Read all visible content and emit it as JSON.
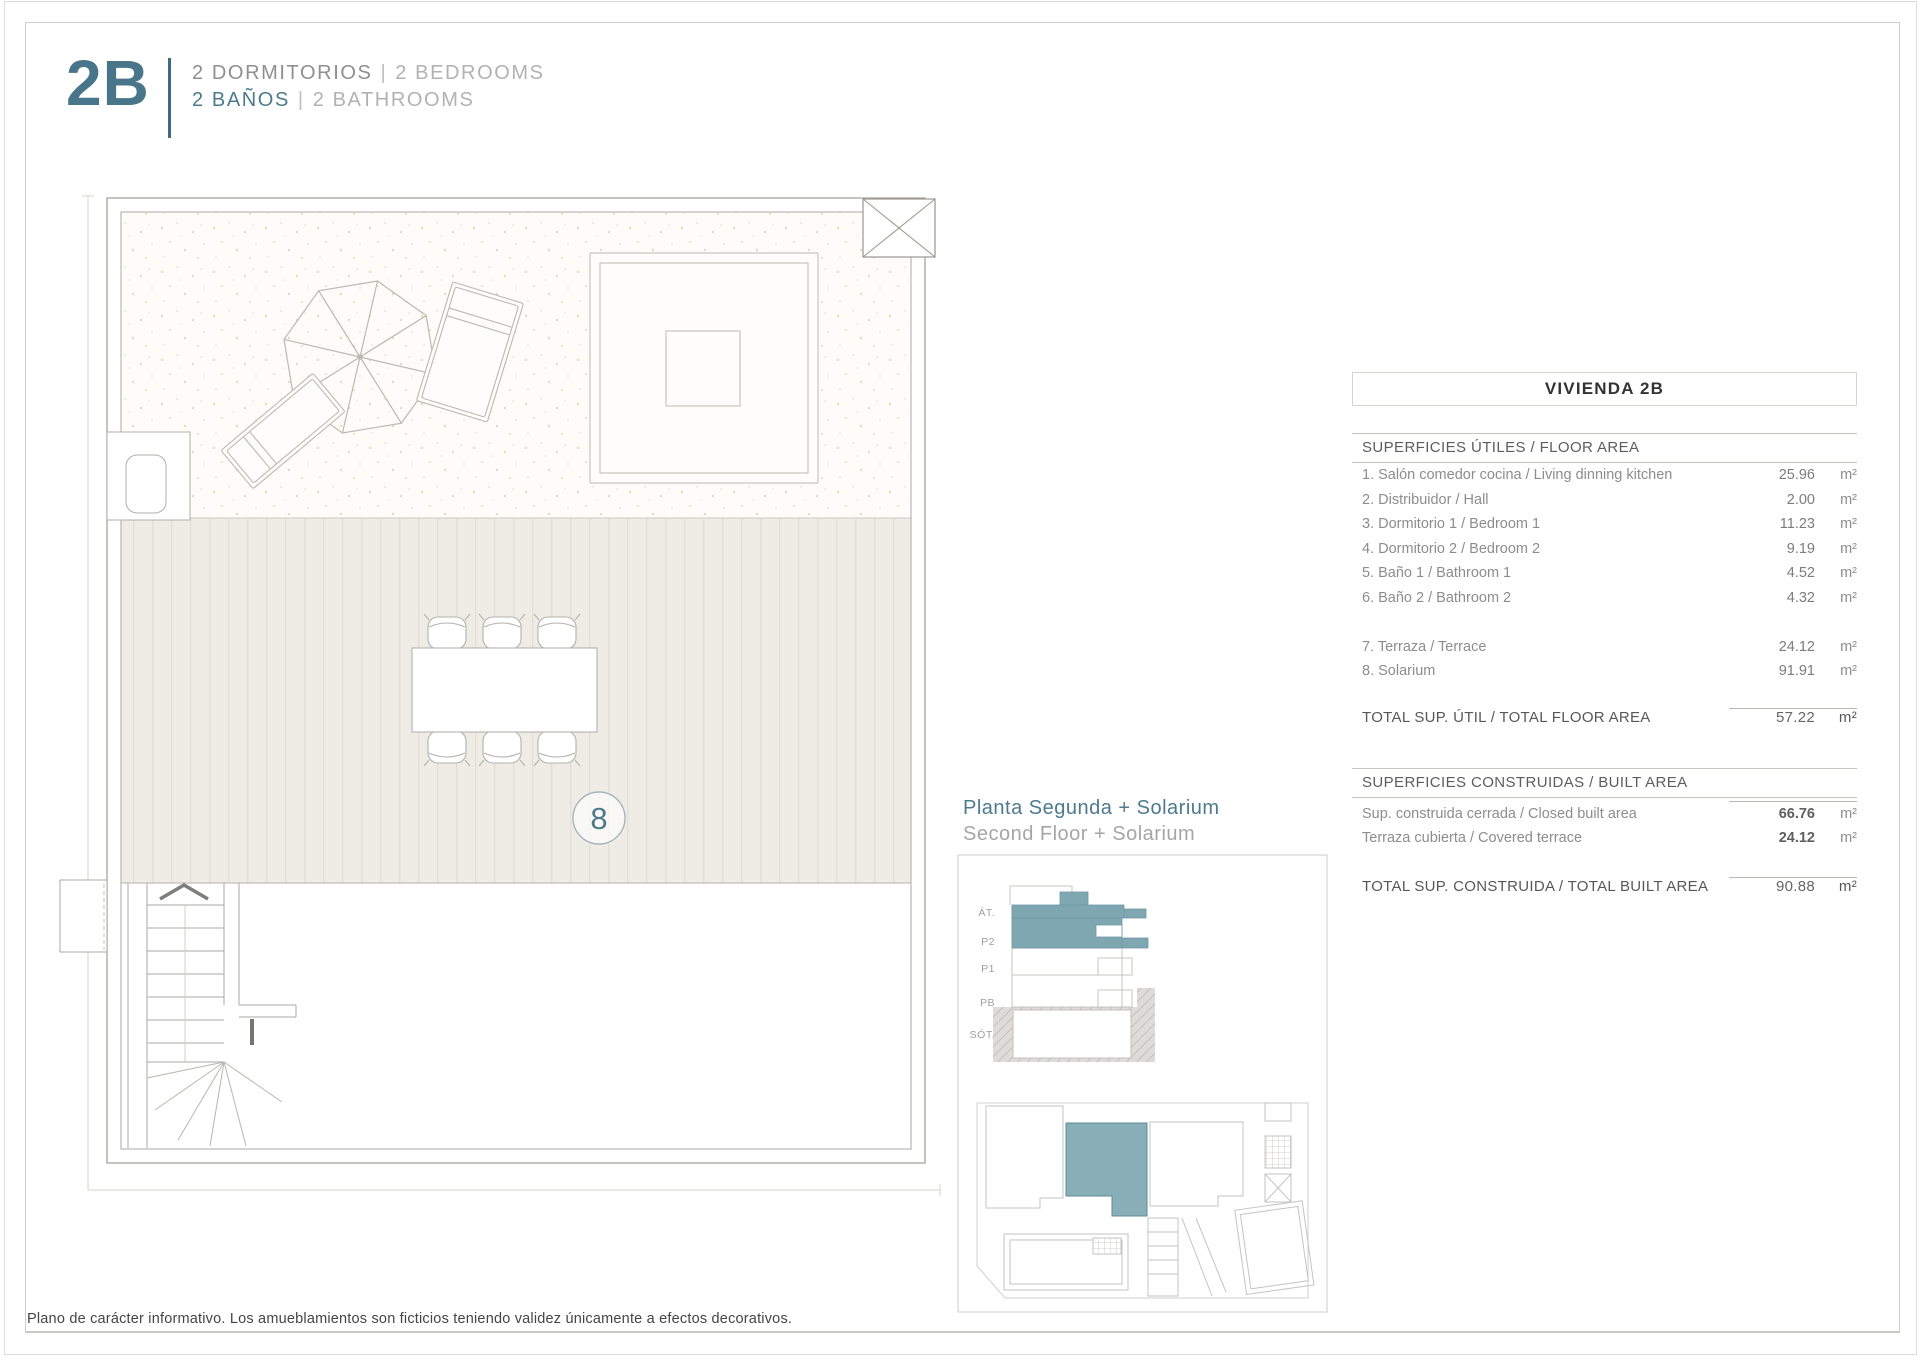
{
  "colors": {
    "accent": "#4d7b8c",
    "highlight": "#7ea7b2"
  },
  "header": {
    "unit_code": "2B",
    "line1": {
      "es": "2 DORMITORIOS",
      "sep": "|",
      "en": "2 BEDROOMS"
    },
    "line2": {
      "es": "2 BAÑOS",
      "sep": "|",
      "en": "2 BATHROOMS"
    }
  },
  "plan": {
    "room_number": "8"
  },
  "plan_caption": {
    "es": "Planta Segunda + Solarium",
    "en": "Second Floor + Solarium"
  },
  "elevation": {
    "labels": [
      "ÁT.",
      "P2",
      "P1",
      "PB",
      "SÓT."
    ]
  },
  "table": {
    "title": "VIVIENDA 2B",
    "section1": "SUPERFICIES ÚTILES / FLOOR AREA",
    "rows1": [
      {
        "label": "1. Salón comedor cocina / Living dinning kitchen",
        "value": "25.96",
        "unit": "m²"
      },
      {
        "label": "2. Distribuidor / Hall",
        "value": "2.00",
        "unit": "m²"
      },
      {
        "label": "3. Dormitorio 1 / Bedroom 1",
        "value": "11.23",
        "unit": "m²"
      },
      {
        "label": "4. Dormitorio 2 / Bedroom 2",
        "value": "9.19",
        "unit": "m²"
      },
      {
        "label": "5. Baño 1 / Bathroom 1",
        "value": "4.52",
        "unit": "m²"
      },
      {
        "label": "6. Baño 2 / Bathroom 2",
        "value": "4.32",
        "unit": "m²"
      },
      {
        "label": "7. Terraza / Terrace",
        "value": "24.12",
        "unit": "m²"
      },
      {
        "label": "8. Solarium",
        "value": "91.91",
        "unit": "m²"
      }
    ],
    "total1": {
      "label": "TOTAL SUP. ÚTIL / TOTAL FLOOR AREA",
      "value": "57.22",
      "unit": "m²"
    },
    "section2": "SUPERFICIES CONSTRUIDAS / BUILT AREA",
    "rows2": [
      {
        "label": "Sup. construida cerrada / Closed built area",
        "value": "66.76",
        "unit": "m²"
      },
      {
        "label": "Terraza cubierta / Covered terrace",
        "value": "24.12",
        "unit": "m²"
      }
    ],
    "total2": {
      "label": "TOTAL SUP. CONSTRUIDA /  TOTAL BUILT AREA",
      "value": "90.88",
      "unit": "m²"
    }
  },
  "disclaimer": "Plano de carácter informativo. Los amueblamientos son ficticios teniendo validez únicamente a efectos decorativos."
}
